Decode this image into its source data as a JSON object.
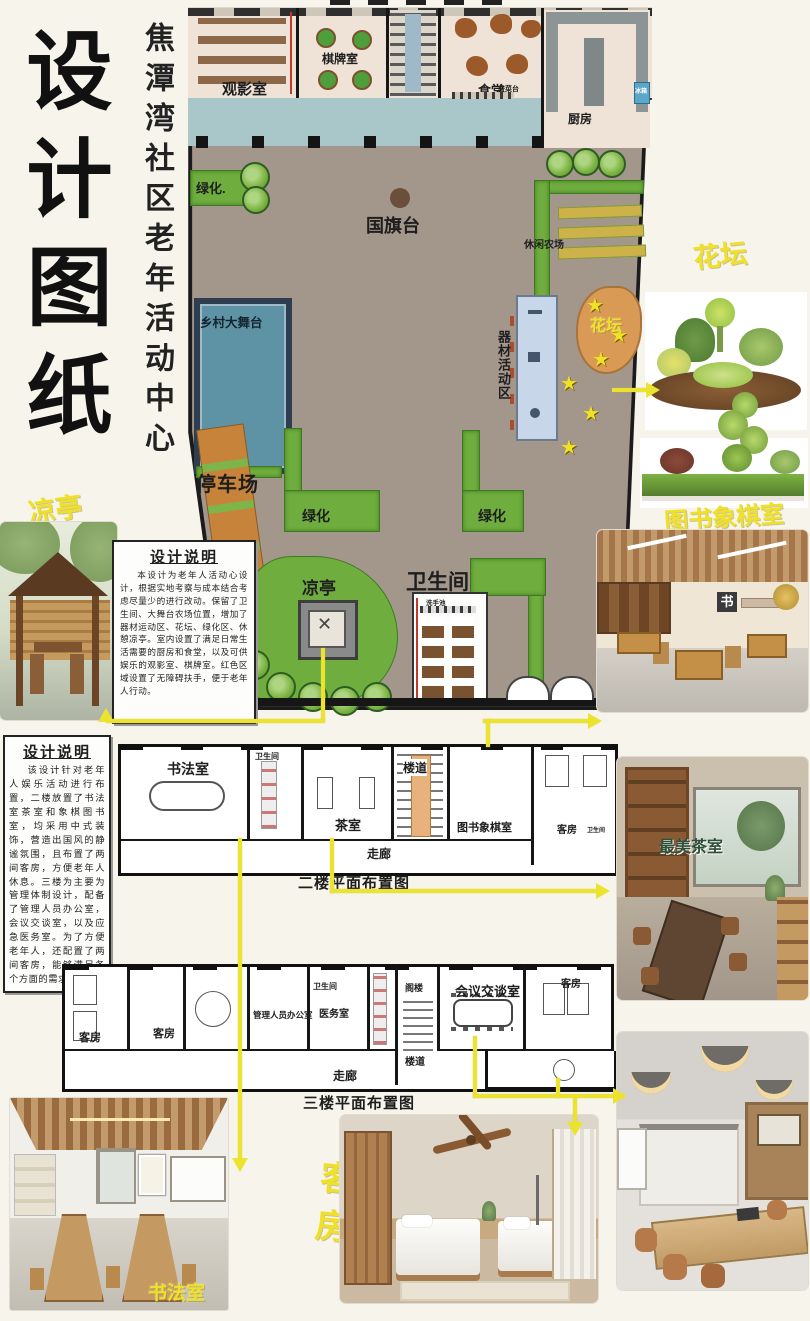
{
  "poster": {
    "title": "设计图纸",
    "subtitle": "焦潭湾社区老年活动中心",
    "accent_yellow": "#f0e126",
    "plaza_color": "#a3968b"
  },
  "site": {
    "screening": "观影室",
    "chess": "棋牌室",
    "canteen": "食堂",
    "serving": "盛菜台",
    "kitchen": "厨房",
    "fridge": "冰箱",
    "greenery1": "绿化.",
    "flag": "国旗台",
    "farm": "休闲农场",
    "stage": "乡村大舞台",
    "equipment": "器材活动区",
    "flowerbed": "花坛",
    "parking": "停车场",
    "greenery2": "绿化",
    "greenery3": "绿化",
    "pavilion": "凉亭",
    "restroom": "卫生间",
    "basin": "洗手池"
  },
  "note1": {
    "title": "设计说明",
    "body": "本设计为老年人活动心设计，根据实地考察与成本结合考虑尽量少的进行改动。保留了卫生间、大舞台农场位置，增加了器材运动区、花坛、绿化区、休憩凉亭。室内设置了满足日常生活需要的厨房和食堂，以及可供娱乐的观影室、棋牌室。红色区域设置了无障碍扶手，便于老年人行动。"
  },
  "note2": {
    "title": "设计说明",
    "body": "该设计针对老年人娱乐活动进行布置，二楼放置了书法室茶室和象棋图书室，均采用中式装饰，营造出国风的静谧氛围，且布置了两间客房，方便老年人休息。三楼为主要为管理体制设计，配备了管理人员办公室，会议交谈室，以及应急医务室。为了方便老年人，还配置了两间客房，能够满足各个方面的需求。"
  },
  "f2": {
    "caption": "二楼平面布置图",
    "calligraphy": "书法室",
    "wc": "卫生间",
    "tea": "茶室",
    "stair": "楼道",
    "library": "图书象棋室",
    "guest": "客房",
    "wc2": "卫生间",
    "corridor": "走廊"
  },
  "f3": {
    "caption": "三楼平面布置图",
    "guest1": "客房",
    "guest2": "客房",
    "office": "管理人员办公室",
    "wc": "卫生间",
    "medical": "医务室",
    "attic": "阁楼",
    "meeting": "会议交谈室",
    "stair": "楼道",
    "guest3": "客房",
    "corridor": "走廊"
  },
  "labels": {
    "pavilion_photo": "凉亭",
    "flowerbed_photo": "花坛",
    "library_photo": "图书象棋室",
    "tea_overlay": "最美茶室",
    "calligraphy_photo": "书法室",
    "guest_photo": "客房",
    "meeting_photo": "会议室"
  }
}
